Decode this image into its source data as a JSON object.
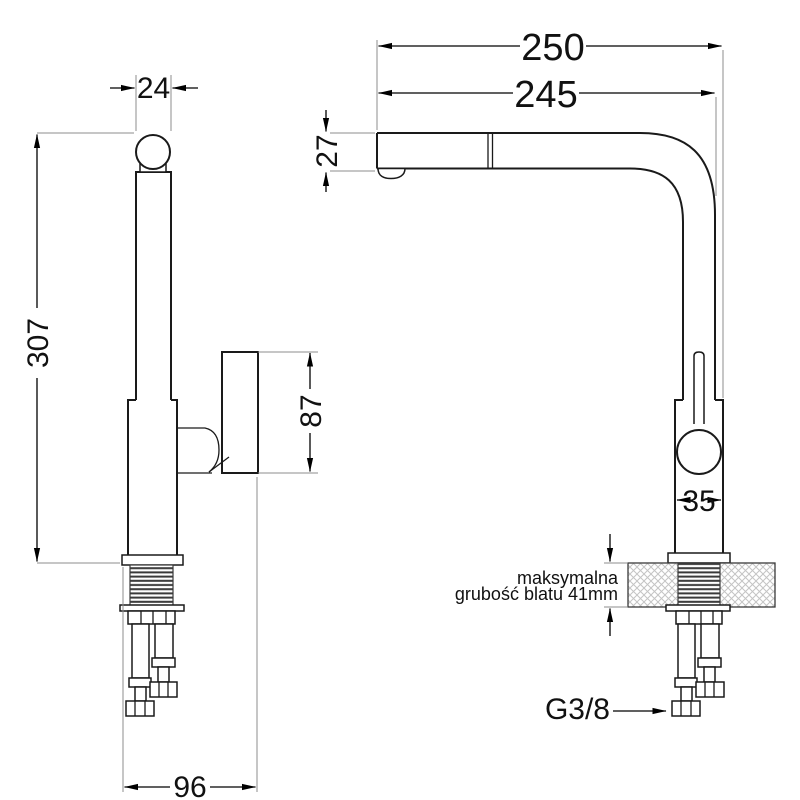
{
  "drawing": {
    "title": "kitchen-faucet-dimensional-drawing",
    "views": {
      "left": "side-profile-view",
      "right": "front-reach-view"
    },
    "dimensions": {
      "spout_pipe_width": "24",
      "total_height": "307",
      "handle_height": "87",
      "base_depth": "96",
      "overall_reach": "250",
      "spout_reach": "245",
      "spout_end_height": "27",
      "body_width": "35"
    },
    "annotations": {
      "countertop_note_line1": "maksymalna",
      "countertop_note_line2": "grubość blatu 41mm",
      "hose_thread_label": "G3/8"
    },
    "colors": {
      "line": "#1a1a1a",
      "dimension": "#000000",
      "extension": "#8e8e8e",
      "hatch": "#c4c4c4",
      "thread_hatch": "#3a3a3a",
      "background": "#ffffff"
    }
  }
}
